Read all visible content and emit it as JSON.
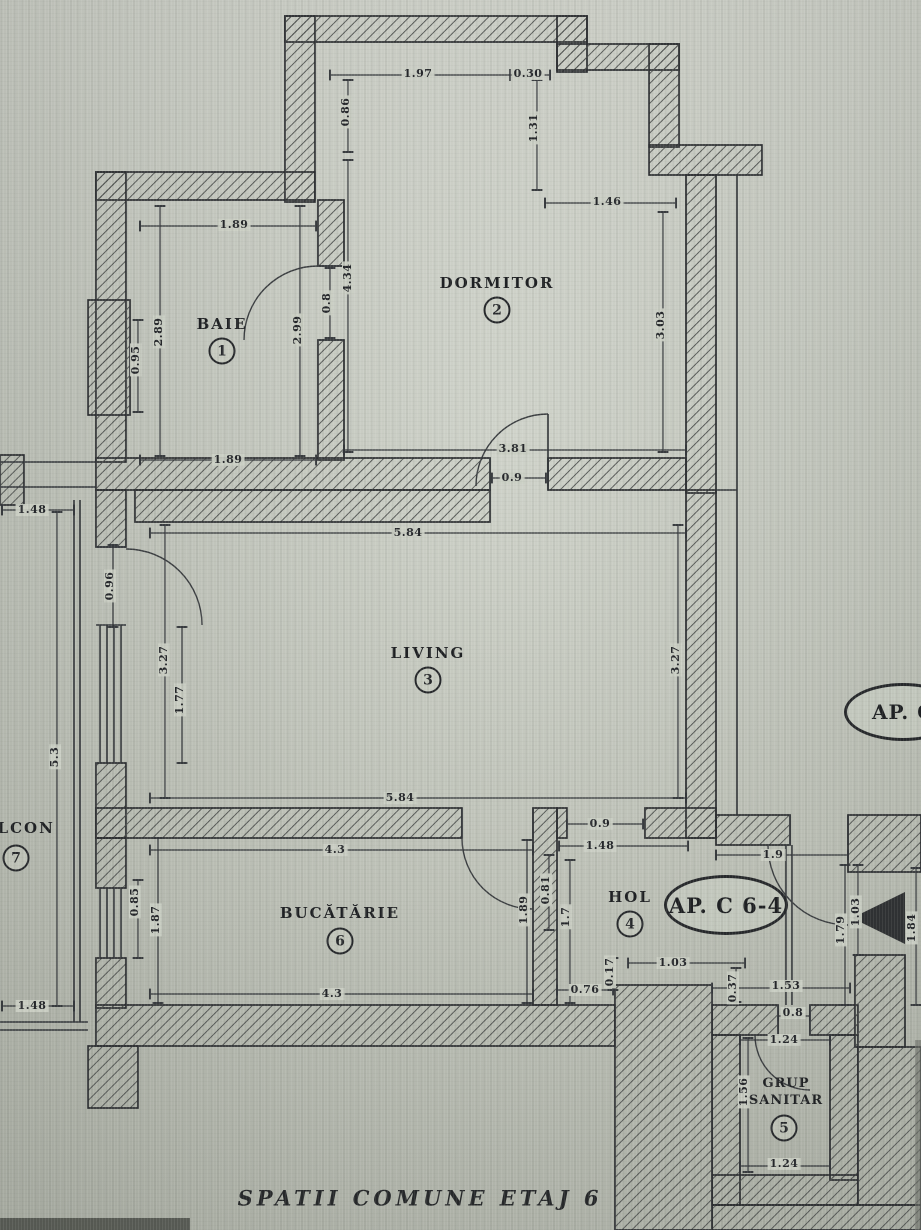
{
  "plan": {
    "caption": "SPATII COMUNE ETAJ 6",
    "badges": {
      "current": "AP. C 6-4",
      "neighbor": "AP. C"
    },
    "rooms": {
      "baie": {
        "name": "BAIE",
        "num": "1"
      },
      "dormitor": {
        "name": "DORMITOR",
        "num": "2"
      },
      "living": {
        "name": "LIVING",
        "num": "3"
      },
      "hol": {
        "name": "HOL",
        "num": "4"
      },
      "grup": {
        "name": "GRUP SANITAR",
        "num": "5"
      },
      "bucatarie": {
        "name": "BUCĂTĂRIE",
        "num": "6"
      },
      "balcon": {
        "name": "BALCON",
        "num": "7"
      }
    },
    "dims": {
      "top_width": "1.97",
      "top_step": "0.30",
      "top_left_h": "0.86",
      "top_right_h": "1.31",
      "dorm_top": "1.46",
      "dorm_left_h": "4.34",
      "dorm_right_h": "3.03",
      "dorm_bottom": "3.81",
      "dorm_door": "0.9",
      "baie_top": "1.89",
      "baie_bottom": "1.89",
      "baie_left_h": "2.89",
      "baie_left_s": "0.95",
      "baie_right_h": "2.99",
      "baie_door": "0.8",
      "living_top": "5.84",
      "living_bottom": "5.84",
      "living_left_h": "3.27",
      "living_right_h": "3.27",
      "living_win": "1.77",
      "balc_door": "0.96",
      "balc_top": "1.48",
      "balc_h": "5.3",
      "balc_bottom": "1.48",
      "kit_top": "4.3",
      "kit_bottom": "4.3",
      "kit_win": "0.85",
      "kit_left_h": "1.87",
      "kit_door_h": "1.89",
      "hol_open": "0.9",
      "hol_top": "1.48",
      "hol_left_s": "0.81",
      "hol_left_h": "1.7",
      "hol_b_s": "0.76",
      "hol_b_t": "0.17",
      "hol_b_w": "1.03",
      "hol_b_step": "0.37",
      "entry_top": "1.9",
      "entry_h1": "1.79",
      "entry_h2": "1.03",
      "entry_right": "1.84",
      "gs_top": "1.53",
      "gs_door": "0.8",
      "gs_in_top": "1.24",
      "gs_left_h": "1.56",
      "gs_bottom": "1.24"
    }
  }
}
